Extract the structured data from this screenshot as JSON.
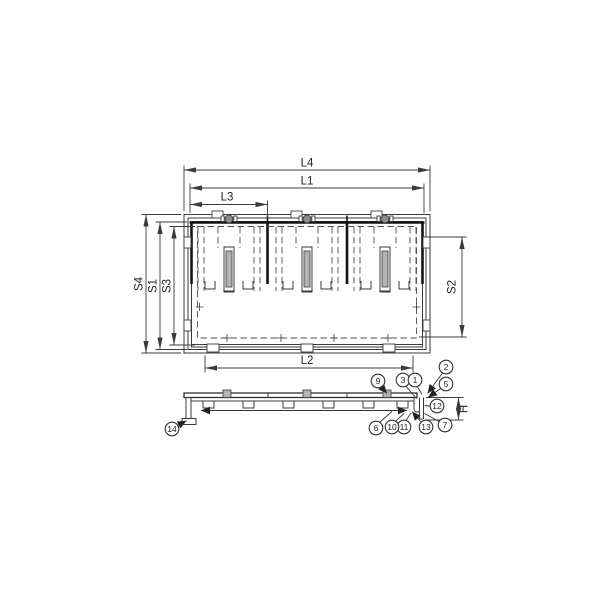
{
  "drawing": {
    "type": "technical-drawing-hatch-covers",
    "views": {
      "plan": "plan-view",
      "section": "section-view"
    },
    "dim_labels": {
      "l4": "L4",
      "l1": "L1",
      "l3": "L3",
      "l2": "L2",
      "s4": "S4",
      "s1": "S1",
      "s3": "S3",
      "s2": "S2",
      "h": "H"
    },
    "callouts": {
      "c1": "1",
      "c2": "2",
      "c3": "3",
      "c5": "5",
      "c6": "6",
      "c7": "7",
      "c9": "9",
      "c10": "10",
      "c11": "11",
      "c12": "12",
      "c13": "13",
      "c14": "14"
    },
    "colors": {
      "line": "#3b3b3b",
      "bold_line": "#141414",
      "hidden_line": "#4f4f4f",
      "slot_fill": "#b3b3b3",
      "background": "#ffffff"
    }
  }
}
